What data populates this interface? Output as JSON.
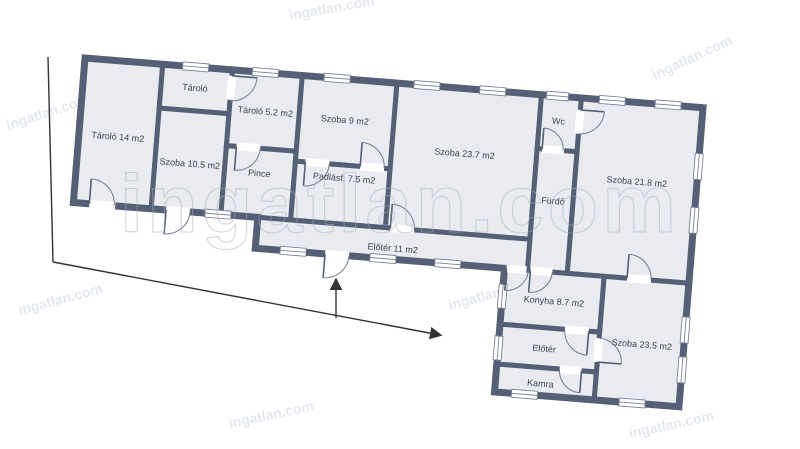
{
  "page": {
    "background": "#ffffff"
  },
  "plan": {
    "wall_color": "#555f75",
    "room_fill": "#e9ebf0",
    "label_color": "#3c4250",
    "rooms": [
      {
        "id": "tarolo-14",
        "label": "Tároló 14 m2"
      },
      {
        "id": "tarolo-small",
        "label": "Tároló"
      },
      {
        "id": "szoba-10-5",
        "label": "Szoba 10.5 m2"
      },
      {
        "id": "tarolo-5-2",
        "label": "Tároló 5.2 m2"
      },
      {
        "id": "pince",
        "label": "Pince"
      },
      {
        "id": "szoba-9",
        "label": "Szoba 9 m2"
      },
      {
        "id": "padlasf-7-5",
        "label": "Padlásf. 7.5 m2"
      },
      {
        "id": "szoba-23-7",
        "label": "Szoba 23.7 m2"
      },
      {
        "id": "wc",
        "label": "Wc"
      },
      {
        "id": "furdo",
        "label": "Fürdő"
      },
      {
        "id": "szoba-21-8",
        "label": "Szoba 21.8 m2"
      },
      {
        "id": "eloter-11",
        "label": "Előtér 11 m2"
      },
      {
        "id": "konyha-8-7",
        "label": "Konyha 8.7 m2"
      },
      {
        "id": "eloter",
        "label": "Előtér"
      },
      {
        "id": "kamra",
        "label": "Kamra"
      },
      {
        "id": "szoba-23-5",
        "label": "Szoba 23.5 m2"
      }
    ]
  },
  "watermark": {
    "center": "ingatlan.com",
    "corner": "ingatlan.com",
    "center_color": "#a9afbb",
    "corner_color": "#c3cede"
  }
}
